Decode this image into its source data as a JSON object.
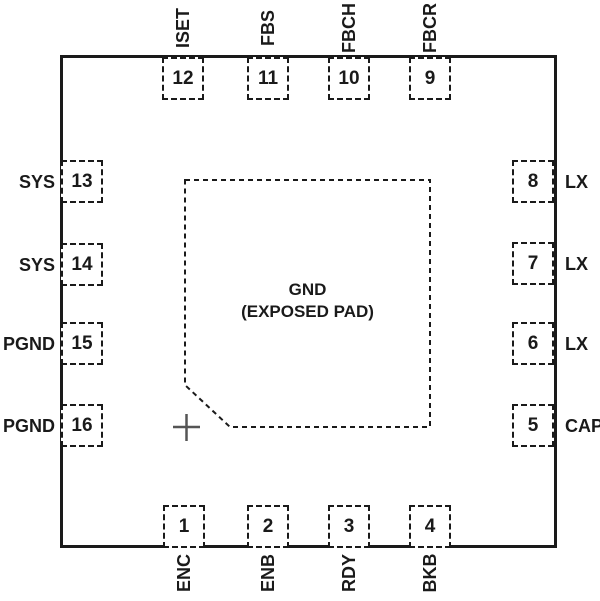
{
  "diagram": {
    "type": "ic-package-pinout",
    "pad": {
      "line1": "GND",
      "line2": "(EXPOSED PAD)"
    },
    "pins": {
      "top": [
        {
          "number": "12",
          "name": "ISET"
        },
        {
          "number": "11",
          "name": "FBS"
        },
        {
          "number": "10",
          "name": "FBCH"
        },
        {
          "number": "9",
          "name": "FBCR"
        }
      ],
      "bottom": [
        {
          "number": "1",
          "name": "ENC"
        },
        {
          "number": "2",
          "name": "ENB"
        },
        {
          "number": "3",
          "name": "RDY"
        },
        {
          "number": "4",
          "name": "BKB"
        }
      ],
      "left": [
        {
          "number": "13",
          "name": "SYS"
        },
        {
          "number": "14",
          "name": "SYS"
        },
        {
          "number": "15",
          "name": "PGND"
        },
        {
          "number": "16",
          "name": "PGND"
        }
      ],
      "right": [
        {
          "number": "8",
          "name": "LX"
        },
        {
          "number": "7",
          "name": "LX"
        },
        {
          "number": "6",
          "name": "LX"
        },
        {
          "number": "5",
          "name": "CAP"
        }
      ]
    },
    "colors": {
      "line": "#1a1a1a",
      "background": "#ffffff"
    }
  }
}
